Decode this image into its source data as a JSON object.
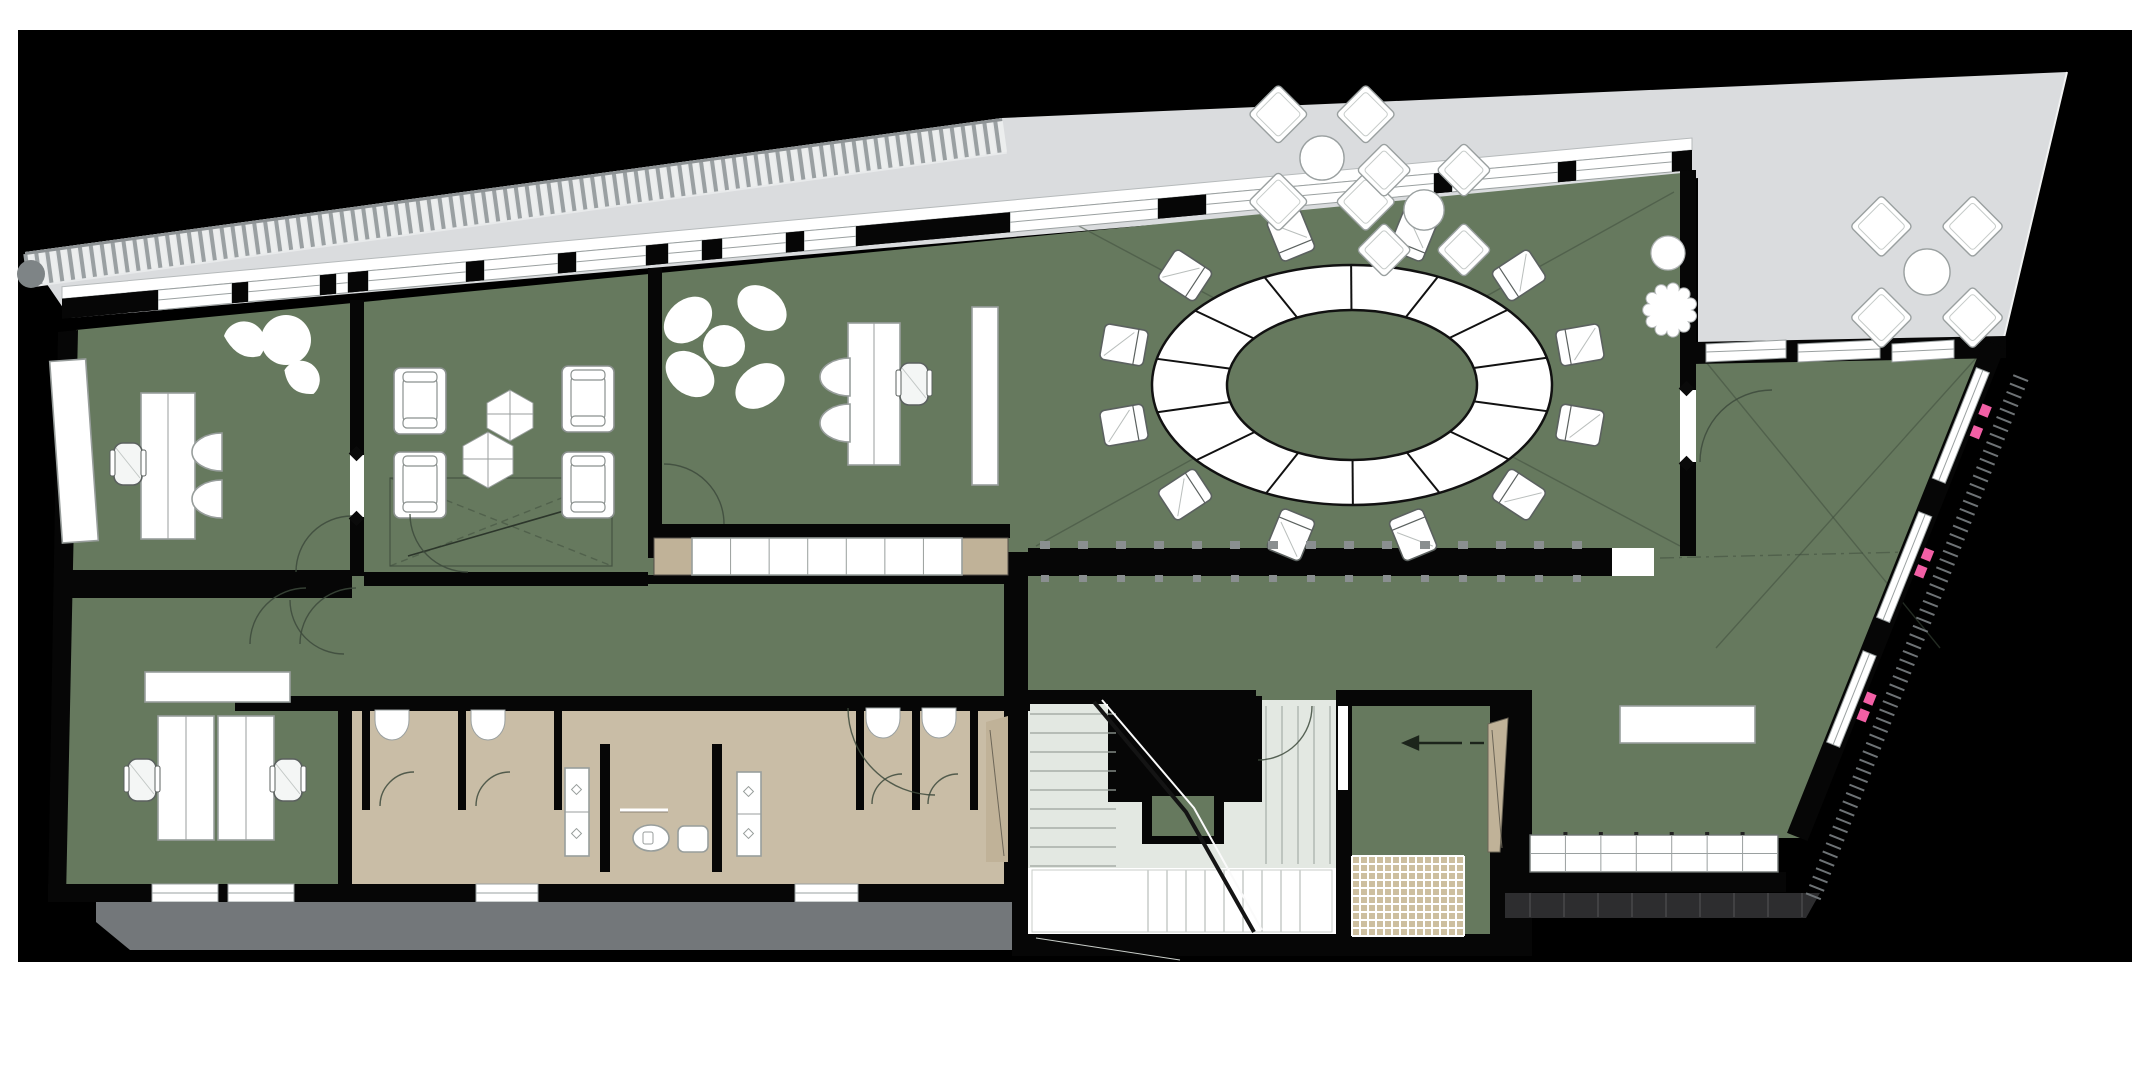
{
  "palette": {
    "page": "#ffffff",
    "canvas": "#000000",
    "green": "#66795e",
    "terrace": "#dadcde",
    "bath": "#c9bda6",
    "bathdark": "#c0b298",
    "stairfloor": "#e3e8e2",
    "mat": "#cdbf9f",
    "sidewalk": "#73777a",
    "stepstrip": "#2d2d2f",
    "wall": "#060606",
    "pink": "#f25fa5",
    "furnstroke": "#989e9c",
    "ribdark": "#9aa0a2",
    "riblight": "#eceeee"
  },
  "plan": {
    "hatch_strip": {
      "x1": 25,
      "y1": 252,
      "x2": 1002,
      "y2": 118,
      "depth": 36,
      "spacing": 11
    },
    "conference_table": {
      "cx": 1352,
      "cy": 385,
      "outer_rx": 200,
      "outer_ry": 120,
      "inner_rx": 125,
      "inner_ry": 75,
      "segments": 14,
      "chairs": 12,
      "chair_rx": 236,
      "chair_ry": 155
    },
    "meeting_armchairs": [
      {
        "x": 394,
        "y": 368
      },
      {
        "x": 562,
        "y": 366
      },
      {
        "x": 394,
        "y": 452
      },
      {
        "x": 562,
        "y": 452
      }
    ],
    "terrace_seating_groups": [
      {
        "cx": 1322,
        "cy": 158,
        "size": 46
      },
      {
        "cx": 1424,
        "cy": 210,
        "size": 42
      },
      {
        "cx": 1927,
        "cy": 272,
        "size": 48
      }
    ],
    "terrace_trees": [
      {
        "cx": 1668,
        "cy": 253,
        "r": 17,
        "style": "smooth"
      },
      {
        "cx": 1670,
        "cy": 310,
        "r": 22,
        "style": "scallop"
      }
    ],
    "kitchen_counter": {
      "x": 1530,
      "y": 835,
      "w": 248,
      "h": 37,
      "cols": 7
    },
    "doormat": {
      "x": 1352,
      "y": 856,
      "w": 112,
      "h": 80,
      "cell": 8
    },
    "teeth_wall": {
      "x1": 1028,
      "x2": 1612,
      "y": 548,
      "h": 28,
      "spacing": 38
    },
    "stairs": {
      "upper_x1": 1030,
      "upper_x2": 1116,
      "upper_y1": 714,
      "upper_y2": 866,
      "step": 19,
      "lower_y1": 870,
      "lower_y2": 932,
      "lower_x1": 1148,
      "lower_x2": 1318,
      "east_x1": 1266,
      "east_x2": 1334,
      "east_y1": 706,
      "east_y2": 864
    },
    "right_wall_line": {
      "x1": 1998,
      "y1": 354,
      "x2": 1806,
      "y2": 834
    },
    "top_wall": {
      "x0": 70,
      "y0": 318,
      "slope": -0.09125,
      "x_end": 1692,
      "piers": [
        [
          62,
          158
        ],
        [
          232,
          248
        ],
        [
          320,
          336
        ],
        [
          348,
          368
        ],
        [
          466,
          484
        ],
        [
          558,
          576
        ],
        [
          646,
          668
        ],
        [
          702,
          722
        ],
        [
          786,
          804
        ],
        [
          856,
          1010
        ],
        [
          1158,
          1206
        ],
        [
          1434,
          1452
        ],
        [
          1558,
          1576
        ],
        [
          1672,
          1692
        ]
      ],
      "windows": [
        [
          158,
          232
        ],
        [
          248,
          320
        ],
        [
          336,
          348
        ],
        [
          368,
          466
        ],
        [
          484,
          558
        ],
        [
          576,
          646
        ],
        [
          668,
          702
        ],
        [
          722,
          786
        ],
        [
          804,
          856
        ],
        [
          1010,
          1158
        ],
        [
          1206,
          1434
        ],
        [
          1452,
          1558
        ],
        [
          1576,
          1672
        ]
      ]
    },
    "bottom_windows": [
      [
        152,
        218
      ],
      [
        228,
        294
      ],
      [
        476,
        538
      ],
      [
        795,
        858
      ]
    ],
    "terrace_door_openings": [
      [
        1706,
        1786
      ],
      [
        1798,
        1880
      ],
      [
        1892,
        1954
      ]
    ]
  }
}
